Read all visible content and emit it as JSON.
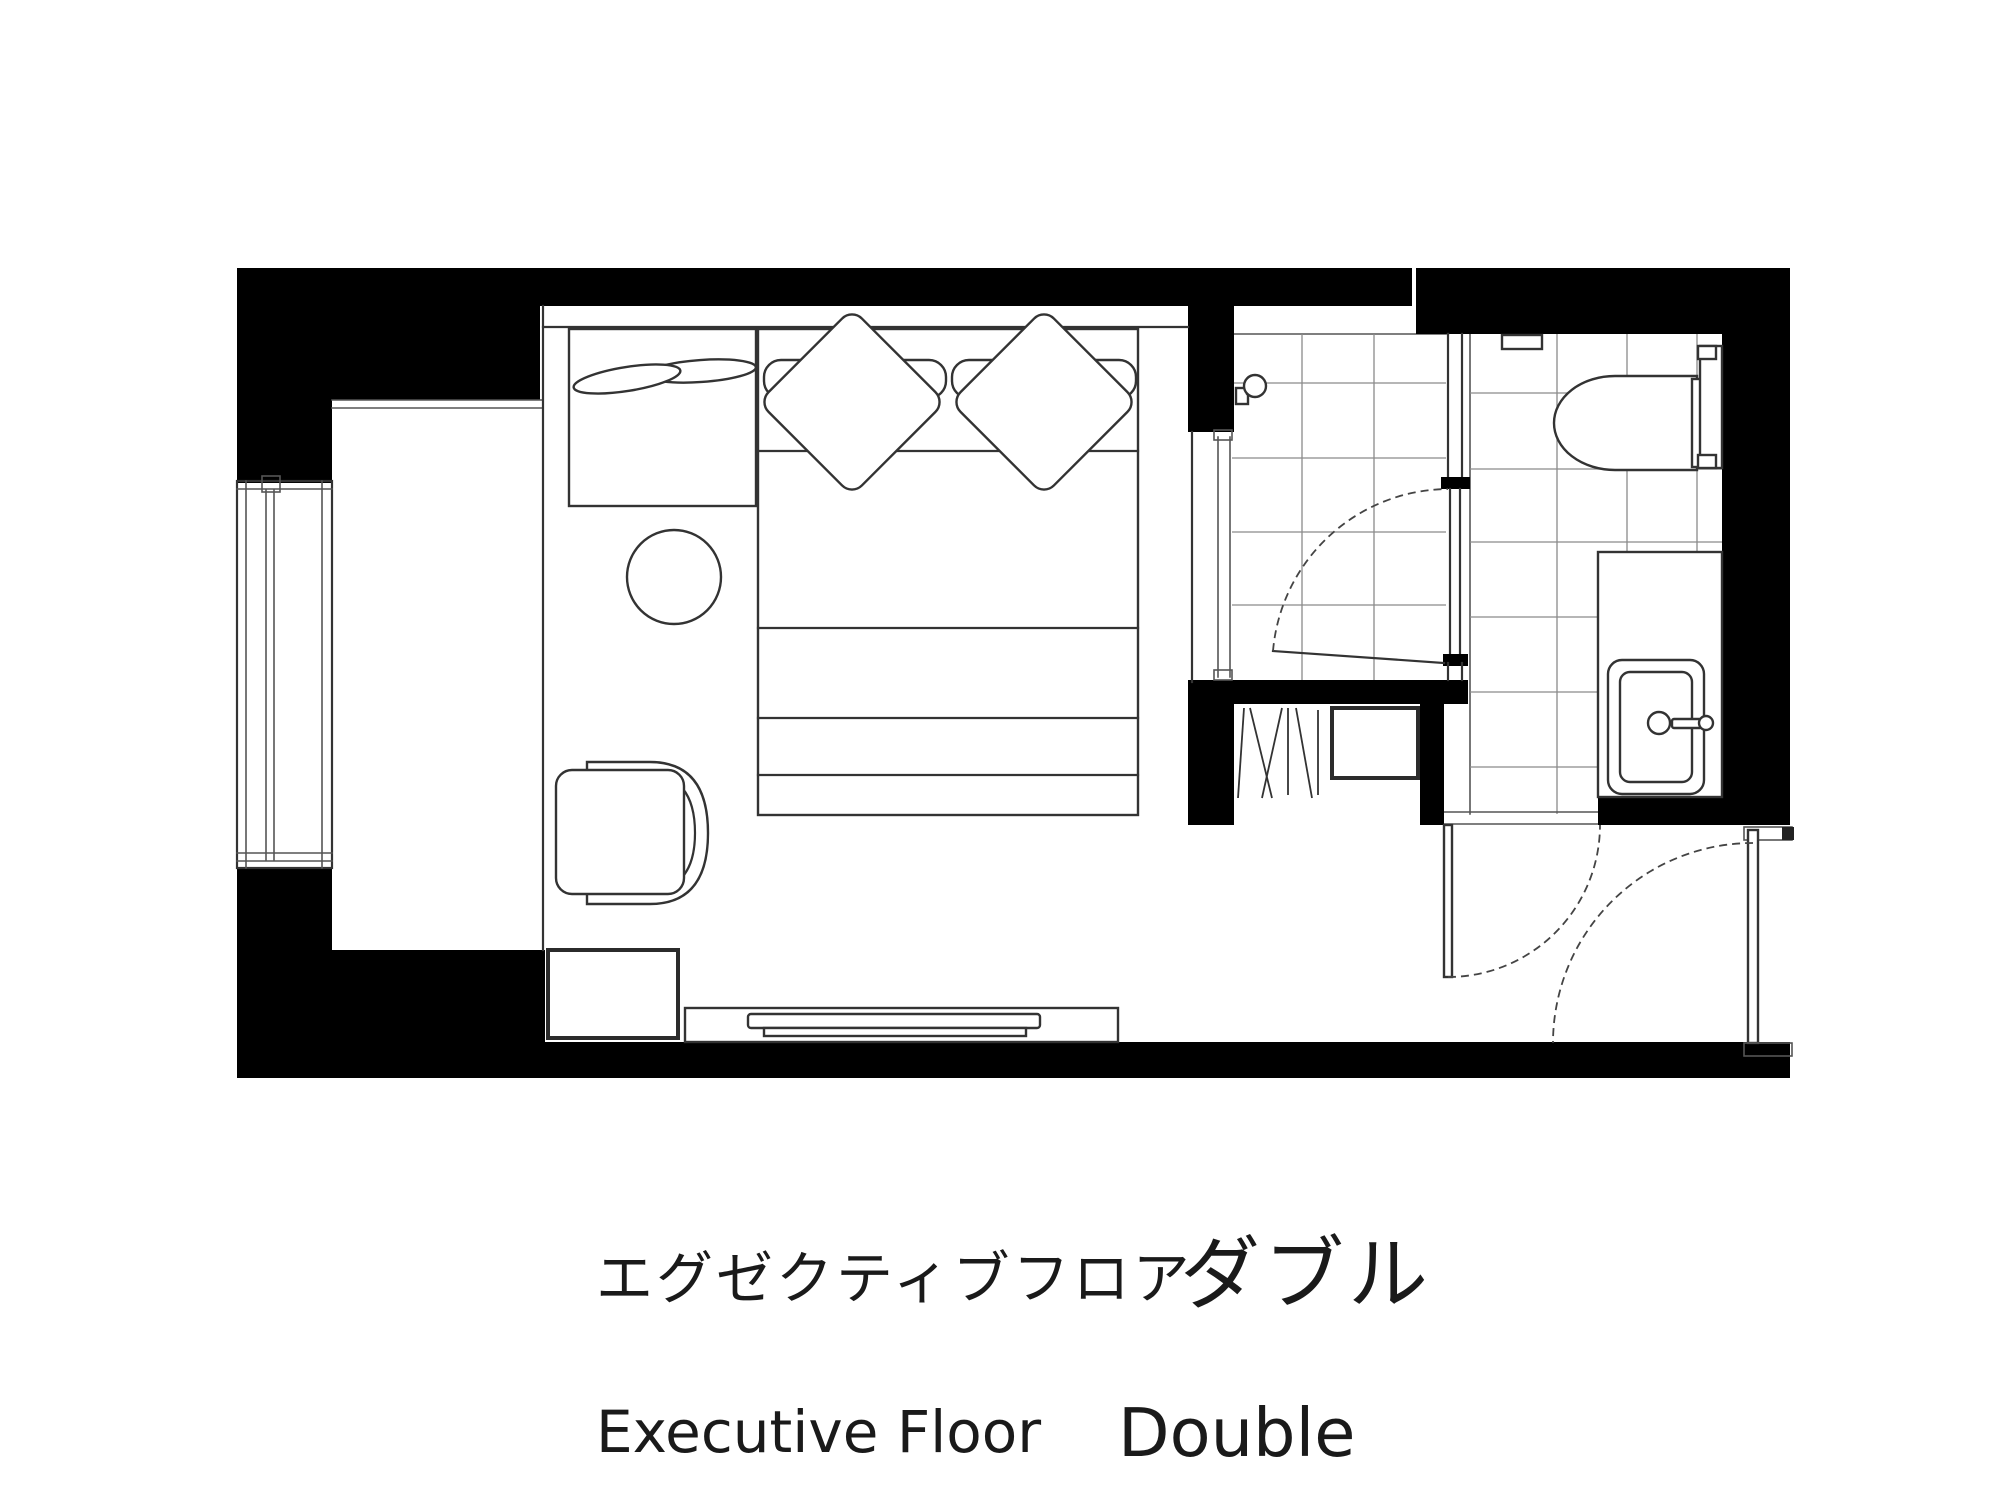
{
  "caption": {
    "jp_regular": "エグゼクティブフロア",
    "jp_emphasis": "ダブル",
    "en_regular": "Executive Floor",
    "en_emphasis": "Double"
  },
  "colors": {
    "background": "#ffffff",
    "wall": "#000000",
    "line": "#333333",
    "tile_line": "#8a8a8a",
    "text": "#1a1a1a"
  },
  "floor_plan": {
    "rooms": [
      "balcony",
      "bedroom",
      "shower-room",
      "toilet-room",
      "closet",
      "entrance-vestibule"
    ],
    "elements": [
      {
        "name": "balcony-window",
        "shape": "triple-track sliding window lines"
      },
      {
        "name": "nightstand",
        "shape": "rectangle with two overlapping oval trays"
      },
      {
        "name": "double-bed",
        "shape": "rectangle with two pillows and two diamond cushions"
      },
      {
        "name": "round-table",
        "shape": "circle"
      },
      {
        "name": "armchair",
        "shape": "wrap-around back chair facing left"
      },
      {
        "name": "luggage-bench",
        "shape": "thick-border square"
      },
      {
        "name": "tv-board",
        "shape": "long low cabinet with tray"
      },
      {
        "name": "glass-partition",
        "shape": "double parallel lines"
      },
      {
        "name": "shower-head",
        "shape": "circle with wall bracket"
      },
      {
        "name": "shower-door",
        "shape": "door leaf with quarter-circle swing arc"
      },
      {
        "name": "closet-hangers",
        "shape": "zigzag hanger lines"
      },
      {
        "name": "safe-box",
        "shape": "small rectangle"
      },
      {
        "name": "bathroom-door",
        "shape": "door leaf with quarter-circle swing arc"
      },
      {
        "name": "toilet",
        "shape": "bowl with cistern"
      },
      {
        "name": "paper-holder-niche",
        "shape": "small wall recess"
      },
      {
        "name": "vanity-counter",
        "shape": "rectangle"
      },
      {
        "name": "wash-basin",
        "shape": "nested rounded rectangles with faucet"
      },
      {
        "name": "entrance-door",
        "shape": "door leaf with quarter-circle swing arc and thresholds"
      }
    ]
  }
}
